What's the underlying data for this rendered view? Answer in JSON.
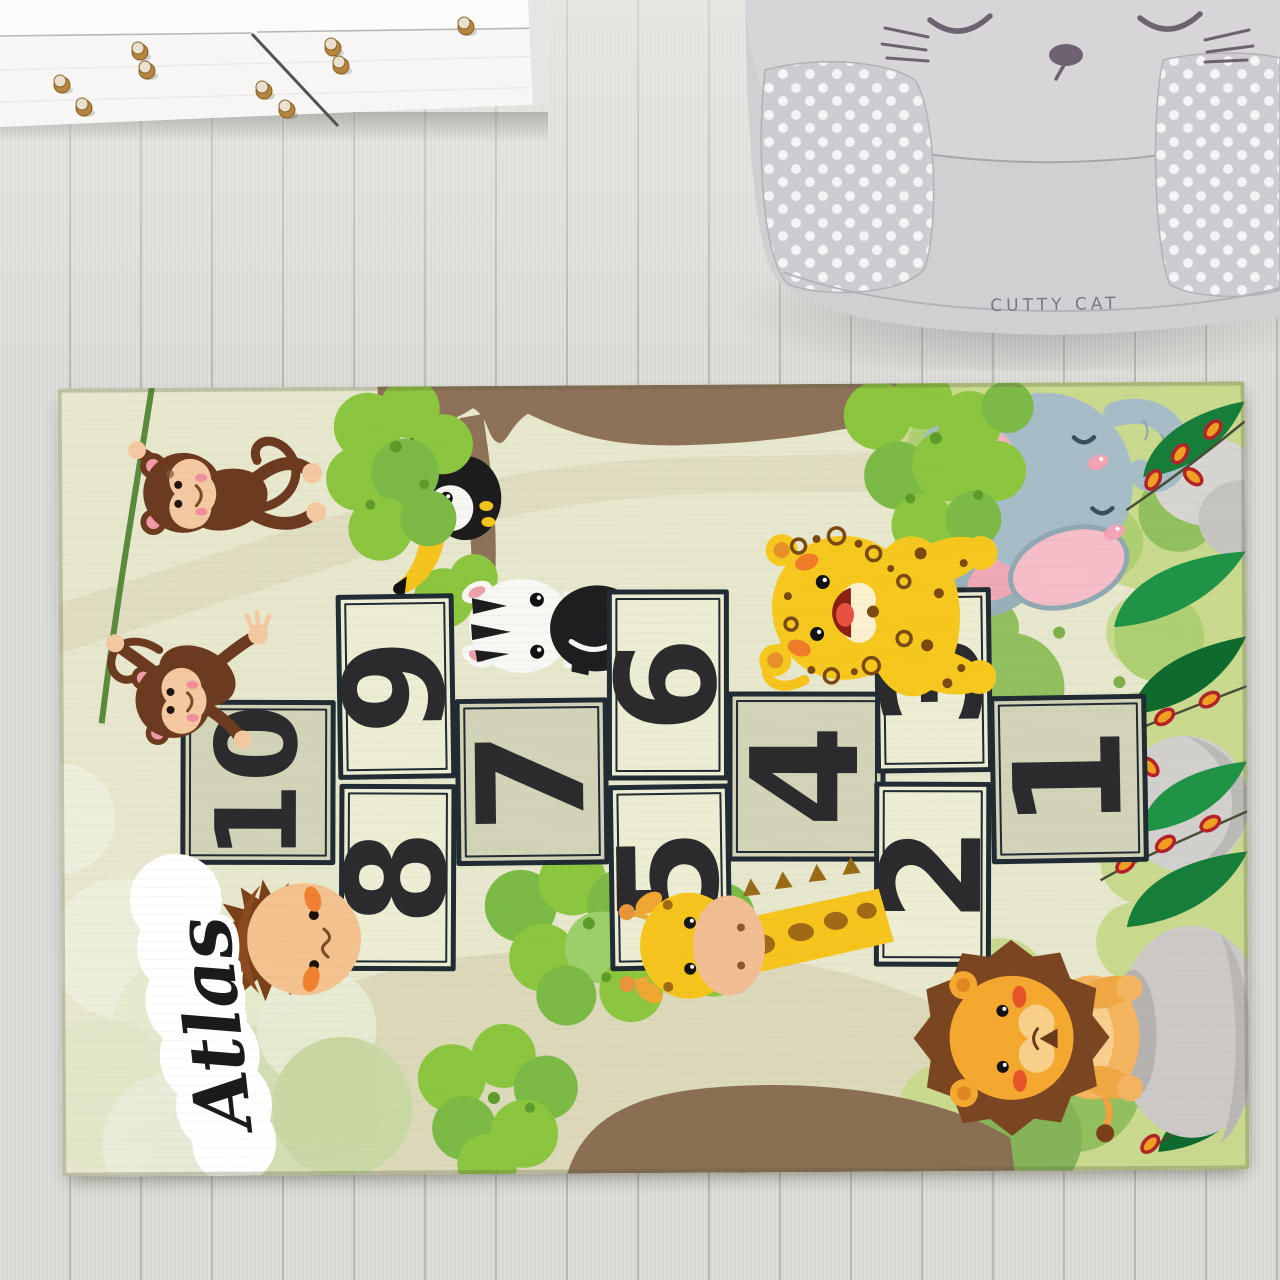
{
  "scene": {
    "type": "product photo",
    "setting": "kids room wood floor with white dresser, cat armchair pouf and personalized hopscotch play rug"
  },
  "furniture": {
    "dresser": {
      "knob_count": 9
    },
    "pouf": {
      "label": "CUTTY CAT"
    }
  },
  "rug": {
    "personalized_name": "Atlas",
    "theme": "jungle animals hopscotch",
    "squares": [
      {
        "number": "1",
        "shade": "dark"
      },
      {
        "number": "2",
        "shade": "light"
      },
      {
        "number": "3",
        "shade": "light"
      },
      {
        "number": "4",
        "shade": "dark"
      },
      {
        "number": "5",
        "shade": "light"
      },
      {
        "number": "6",
        "shade": "light"
      },
      {
        "number": "7",
        "shade": "dark"
      },
      {
        "number": "8",
        "shade": "light"
      },
      {
        "number": "9",
        "shade": "light"
      },
      {
        "number": "10",
        "shade": "dark"
      }
    ],
    "animals": [
      {
        "label": "monkey swinging on vine"
      },
      {
        "label": "monkey hanging on vine"
      },
      {
        "label": "toucan on branch"
      },
      {
        "label": "zebra peeking"
      },
      {
        "label": "leopard cub laughing"
      },
      {
        "label": "sleeping elephant"
      },
      {
        "label": "giraffe"
      },
      {
        "label": "lion cub"
      },
      {
        "label": "boy peeking"
      }
    ],
    "colors": {
      "base": "#e7e7cd",
      "square_light": "#ecedd3",
      "square_dark": "#d3d3b8",
      "border": "#202b33",
      "number": "#2b2b2e",
      "name_text": "#1a1a1a"
    }
  }
}
